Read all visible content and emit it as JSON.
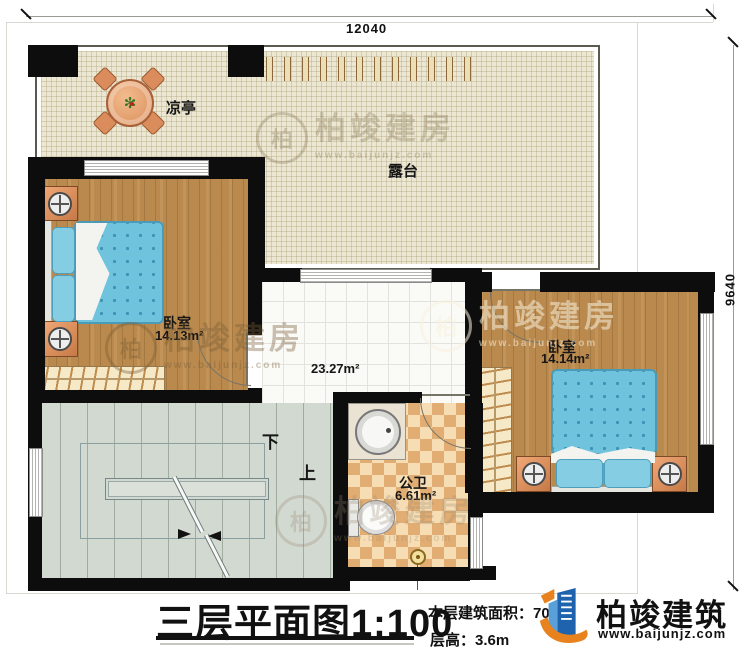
{
  "dimensions": {
    "top": "12040",
    "right": "9640"
  },
  "rooms": {
    "pavilion": {
      "label": "凉亭"
    },
    "terrace": {
      "label": "露台"
    },
    "bedroom_left": {
      "label": "卧室",
      "area": "14.13m²"
    },
    "hall": {
      "area": "23.27m²"
    },
    "bedroom_right": {
      "label": "卧室",
      "area": "14.14m²"
    },
    "bathroom": {
      "label": "公卫",
      "area": "6.61m²"
    },
    "stairs": {
      "down_label": "下",
      "up_label": "上"
    }
  },
  "title_block": {
    "title": "三层平面图",
    "scale": "1:100",
    "floor_area": "本层建筑面积：70",
    "floor_height": "层高：3.6m",
    "brand": "柏竣建筑",
    "website": "www.baijunjz.com"
  },
  "watermark": {
    "brand": "柏竣建房",
    "website": "www.baijunjz.com",
    "monogram": "柏"
  },
  "colors": {
    "wall": "#0d0d0d",
    "wood": "#b9894d",
    "terrace": "#ece7d3",
    "mattress": "#6fc3dc",
    "bath_checker": "#e2ad72",
    "stairs": "#d2d9d0",
    "brand_blue": "#1f63ae",
    "brand_orange": "#e8821e"
  }
}
